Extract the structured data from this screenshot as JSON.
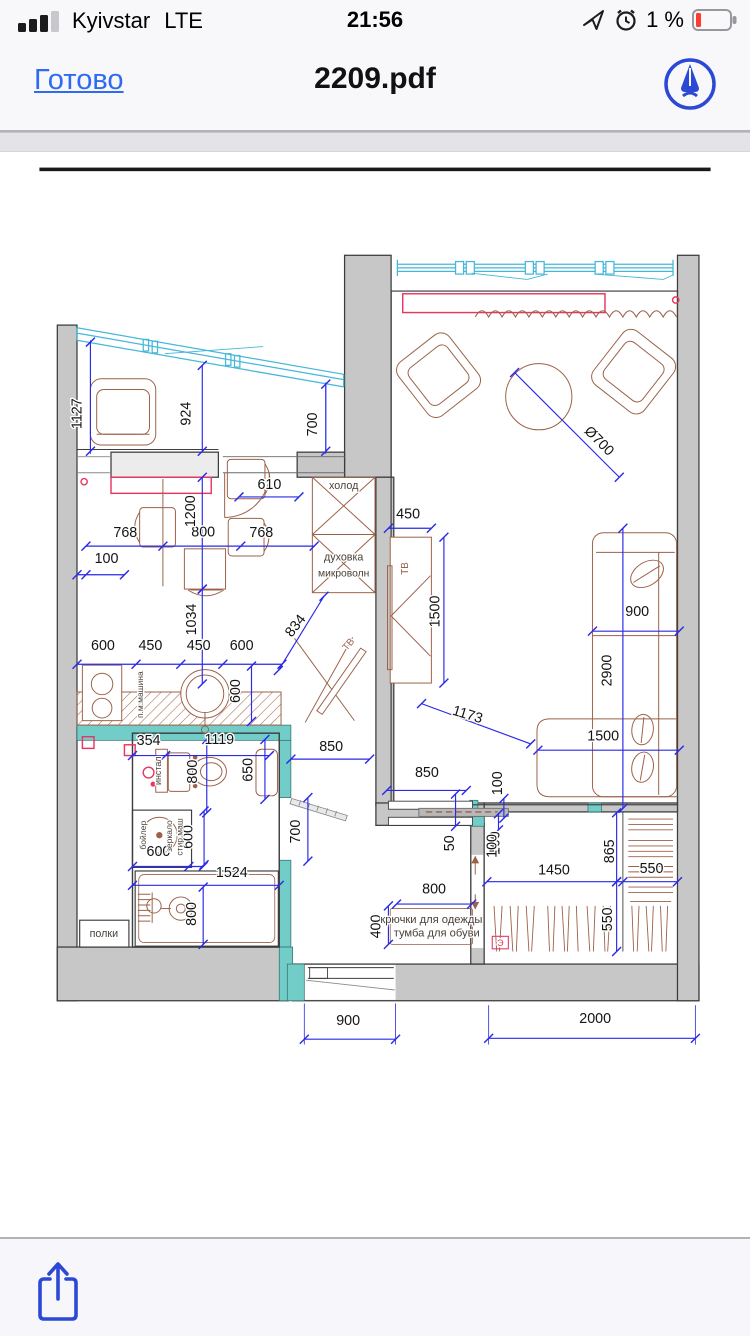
{
  "status_bar": {
    "carrier": "Kyivstar",
    "network": "LTE",
    "time": "21:56",
    "battery_percent": "1 %"
  },
  "nav_bar": {
    "done_label": "Готово",
    "title": "2209.pdf"
  },
  "toolbar": {
    "share_action": "share"
  },
  "colors": {
    "accent_blue": "#2f6bf2",
    "icon_blue": "#2b49d4",
    "dim_blue": "#2a2ae8",
    "wall_gray": "#c8c7c7",
    "teal": "#72cdc8",
    "furniture_brown": "#9b6149",
    "window_cyan": "#45b7d9",
    "red_accent": "#e8365e",
    "battery_red": "#ff3b30"
  },
  "plan": {
    "dims": [
      {
        "t": "1127",
        "x": 47,
        "y": 447,
        "r": -90
      },
      {
        "t": "924",
        "x": 169,
        "y": 447,
        "r": -90
      },
      {
        "t": "700",
        "x": 310,
        "y": 459,
        "r": -90
      },
      {
        "t": "Ø700",
        "x": 622,
        "y": 481,
        "r": 45
      },
      {
        "t": "610",
        "x": 257,
        "y": 531,
        "r": 0
      },
      {
        "t": "768",
        "x": 96,
        "y": 585,
        "r": 0
      },
      {
        "t": "800",
        "x": 183,
        "y": 584,
        "r": 0
      },
      {
        "t": "768",
        "x": 248,
        "y": 585,
        "r": 0
      },
      {
        "t": "100",
        "x": 75,
        "y": 614,
        "r": 0
      },
      {
        "t": "1200",
        "x": 174,
        "y": 556,
        "r": -90
      },
      {
        "t": "1034",
        "x": 175,
        "y": 677,
        "r": -90
      },
      {
        "t": "834",
        "x": 290,
        "y": 687,
        "r": -52
      },
      {
        "t": "600",
        "x": 71,
        "y": 711,
        "r": 0
      },
      {
        "t": "450",
        "x": 124,
        "y": 711,
        "r": 0
      },
      {
        "t": "450",
        "x": 178,
        "y": 711,
        "r": 0
      },
      {
        "t": "600",
        "x": 226,
        "y": 711,
        "r": 0
      },
      {
        "t": "600",
        "x": 224,
        "y": 757,
        "r": -90
      },
      {
        "t": "450",
        "x": 412,
        "y": 564,
        "r": 0
      },
      {
        "t": "1500",
        "x": 447,
        "y": 668,
        "r": -90
      },
      {
        "t": "900",
        "x": 668,
        "y": 673,
        "r": 0
      },
      {
        "t": "2900",
        "x": 639,
        "y": 734,
        "r": -90
      },
      {
        "t": "1173",
        "x": 477,
        "y": 788,
        "r": 17
      },
      {
        "t": "1500",
        "x": 630,
        "y": 812,
        "r": 0
      },
      {
        "t": "850",
        "x": 326,
        "y": 824,
        "r": 0
      },
      {
        "t": "850",
        "x": 433,
        "y": 853,
        "r": 0
      },
      {
        "t": "100",
        "x": 517,
        "y": 860,
        "r": -90
      },
      {
        "t": "50",
        "x": 463,
        "y": 927,
        "r": -90
      },
      {
        "t": "100",
        "x": 514,
        "y": 927,
        "r": -90
      },
      {
        "t": "700",
        "x": 291,
        "y": 914,
        "r": -90
      },
      {
        "t": "354",
        "x": 122,
        "y": 817,
        "r": 0
      },
      {
        "t": "1119",
        "x": 201,
        "y": 816,
        "r": 0
      },
      {
        "t": "650",
        "x": 238,
        "y": 845,
        "r": -90
      },
      {
        "t": "800",
        "x": 176,
        "y": 847,
        "r": -90
      },
      {
        "t": "600",
        "x": 133,
        "y": 941,
        "r": 0
      },
      {
        "t": "600",
        "x": 171,
        "y": 920,
        "r": -90
      },
      {
        "t": "1524",
        "x": 215,
        "y": 965,
        "r": 0
      },
      {
        "t": "800",
        "x": 175,
        "y": 1006,
        "r": -90
      },
      {
        "t": "800",
        "x": 441,
        "y": 983,
        "r": 0
      },
      {
        "t": "400",
        "x": 381,
        "y": 1020,
        "r": -90
      },
      {
        "t": "100",
        "x": 511,
        "y": 930,
        "r": -90
      },
      {
        "t": "865",
        "x": 642,
        "y": 936,
        "r": -90
      },
      {
        "t": "1450",
        "x": 575,
        "y": 962,
        "r": 0
      },
      {
        "t": "550",
        "x": 684,
        "y": 960,
        "r": 0
      },
      {
        "t": "550",
        "x": 640,
        "y": 1012,
        "r": -90
      },
      {
        "t": "900",
        "x": 345,
        "y": 1130,
        "r": 0
      },
      {
        "t": "2000",
        "x": 621,
        "y": 1128,
        "r": 0
      }
    ],
    "labels": [
      {
        "t": "холод",
        "x": 340,
        "y": 531,
        "r": 0,
        "s": 12,
        "c": "dark"
      },
      {
        "t": "духовка",
        "x": 340,
        "y": 611,
        "r": 0,
        "s": 12,
        "c": "dark"
      },
      {
        "t": "микроволн",
        "x": 340,
        "y": 629,
        "r": 0,
        "s": 11.5,
        "c": "dark"
      },
      {
        "t": "ТВ",
        "x": 348,
        "y": 707,
        "r": -50,
        "s": 11,
        "c": "brown"
      },
      {
        "t": "ТВ",
        "x": 412,
        "y": 620,
        "r": -90,
        "s": 11,
        "c": "brown"
      },
      {
        "t": "п.м.машина",
        "x": 116,
        "y": 761,
        "r": -90,
        "s": 9.5,
        "c": "dark"
      },
      {
        "t": "инстал",
        "x": 136,
        "y": 846,
        "r": -90,
        "s": 10,
        "c": "dark"
      },
      {
        "t": "бойлер",
        "x": 119,
        "y": 918,
        "r": -90,
        "s": 9.5,
        "c": "dark"
      },
      {
        "t": "зеркало",
        "x": 148,
        "y": 919,
        "r": -90,
        "s": 9.5,
        "c": "dark"
      },
      {
        "t": "стир.маш",
        "x": 160,
        "y": 920,
        "r": -90,
        "s": 9.5,
        "c": "dark"
      },
      {
        "t": "полки",
        "x": 72,
        "y": 1032,
        "r": 0,
        "s": 12,
        "c": "dark"
      },
      {
        "t": "крючки для одежды",
        "x": 438,
        "y": 1016,
        "r": 0,
        "s": 12.5,
        "c": "dark"
      },
      {
        "t": "тумба для обуви",
        "x": 444,
        "y": 1031,
        "r": 0,
        "s": 12.5,
        "c": "dark"
      },
      {
        "t": "Э",
        "x": 515,
        "y": 1042,
        "r": 0,
        "s": 10,
        "c": "red"
      }
    ],
    "dim_lines": [
      {
        "x1": 57,
        "y1": 367,
        "x2": 57,
        "y2": 489
      },
      {
        "x1": 182,
        "y1": 393,
        "x2": 182,
        "y2": 489
      },
      {
        "x1": 320,
        "y1": 414,
        "x2": 320,
        "y2": 489
      },
      {
        "x1": 531,
        "y1": 401,
        "x2": 648,
        "y2": 518
      },
      {
        "x1": 223,
        "y1": 540,
        "x2": 290,
        "y2": 540
      },
      {
        "x1": 52,
        "y1": 595,
        "x2": 307,
        "y2": 595,
        "m": [
          [
            138,
            595
          ],
          [
            225,
            595
          ]
        ]
      },
      {
        "x1": 42,
        "y1": 627,
        "x2": 95,
        "y2": 627,
        "m": [
          [
            52,
            627
          ]
        ]
      },
      {
        "x1": 182,
        "y1": 518,
        "x2": 182,
        "y2": 643
      },
      {
        "x1": 182,
        "y1": 643,
        "x2": 182,
        "y2": 749
      },
      {
        "x1": 318,
        "y1": 651,
        "x2": 267,
        "y2": 734
      },
      {
        "x1": 42,
        "y1": 727,
        "x2": 271,
        "y2": 727,
        "m": [
          [
            108,
            727
          ],
          [
            158,
            727
          ],
          [
            205,
            727
          ]
        ]
      },
      {
        "x1": 237,
        "y1": 729,
        "x2": 237,
        "y2": 791
      },
      {
        "x1": 390,
        "y1": 575,
        "x2": 438,
        "y2": 575
      },
      {
        "x1": 452,
        "y1": 585,
        "x2": 452,
        "y2": 748
      },
      {
        "x1": 618,
        "y1": 690,
        "x2": 715,
        "y2": 690
      },
      {
        "x1": 652,
        "y1": 575,
        "x2": 652,
        "y2": 888
      },
      {
        "x1": 557,
        "y1": 823,
        "x2": 715,
        "y2": 823
      },
      {
        "x1": 427,
        "y1": 771,
        "x2": 549,
        "y2": 816
      },
      {
        "x1": 281,
        "y1": 833,
        "x2": 369,
        "y2": 833
      },
      {
        "x1": 388,
        "y1": 868,
        "x2": 477,
        "y2": 868
      },
      {
        "x1": 519,
        "y1": 877,
        "x2": 519,
        "y2": 899
      },
      {
        "x1": 465,
        "y1": 872,
        "x2": 465,
        "y2": 908
      },
      {
        "x1": 513,
        "y1": 894,
        "x2": 513,
        "y2": 912
      },
      {
        "x1": 300,
        "y1": 876,
        "x2": 300,
        "y2": 947
      },
      {
        "x1": 104,
        "y1": 829,
        "x2": 257,
        "y2": 829,
        "m": [
          [
            141,
            829
          ]
        ]
      },
      {
        "x1": 252,
        "y1": 811,
        "x2": 252,
        "y2": 878
      },
      {
        "x1": 187,
        "y1": 811,
        "x2": 187,
        "y2": 893
      },
      {
        "x1": 104,
        "y1": 953,
        "x2": 183,
        "y2": 953,
        "m": [
          [
            167,
            953
          ]
        ]
      },
      {
        "x1": 184,
        "y1": 891,
        "x2": 184,
        "y2": 951
      },
      {
        "x1": 104,
        "y1": 974,
        "x2": 268,
        "y2": 974
      },
      {
        "x1": 183,
        "y1": 976,
        "x2": 183,
        "y2": 1040
      },
      {
        "x1": 399,
        "y1": 995,
        "x2": 483,
        "y2": 995
      },
      {
        "x1": 390,
        "y1": 997,
        "x2": 390,
        "y2": 1040
      },
      {
        "x1": 500,
        "y1": 970,
        "x2": 713,
        "y2": 970,
        "m": [
          [
            652,
            970
          ]
        ]
      },
      {
        "x1": 645,
        "y1": 893,
        "x2": 645,
        "y2": 970
      },
      {
        "x1": 645,
        "y1": 970,
        "x2": 645,
        "y2": 1048
      },
      {
        "x1": 502,
        "y1": 1145,
        "x2": 733,
        "y2": 1145
      },
      {
        "x1": 296,
        "y1": 1146,
        "x2": 398,
        "y2": 1146
      }
    ],
    "ext_lines": [
      [
        296,
        1106,
        296,
        1152
      ],
      [
        398,
        1106,
        398,
        1152
      ],
      [
        502,
        1108,
        502,
        1152
      ],
      [
        733,
        1108,
        733,
        1152
      ],
      [
        57,
        365,
        57,
        492
      ],
      [
        320,
        412,
        320,
        492
      ]
    ]
  }
}
